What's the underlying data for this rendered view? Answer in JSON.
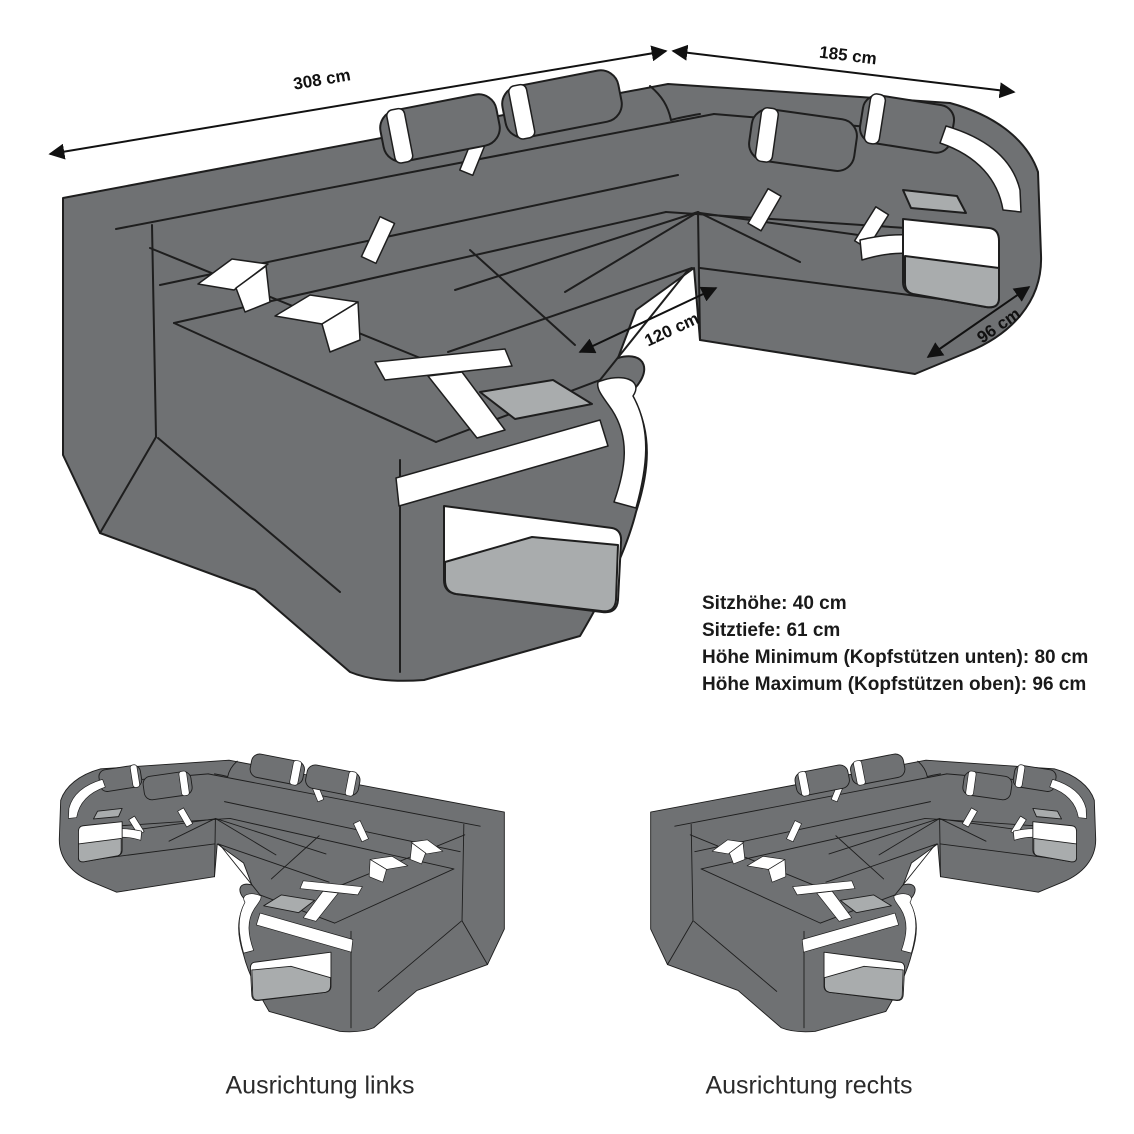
{
  "diagram": {
    "dimensions": {
      "back_width": "308 cm",
      "side_depth": "185 cm",
      "inner_width": "120 cm",
      "corner_depth": "96 cm"
    },
    "specs": {
      "line1": "Sitzhöhe: 40 cm",
      "line2": "Sitztiefe: 61 cm",
      "line3": "Höhe Minimum (Kopfstützen unten): 80 cm",
      "line4": "Höhe Maximum (Kopfstützen oben): 96 cm"
    },
    "variants": {
      "left_label": "Ausrichtung links",
      "right_label": "Ausrichtung rechts"
    },
    "colors": {
      "sofa_body": "#6f7173",
      "panel_light": "#a9acad",
      "accent_stripe": "#ffffff",
      "outline": "#1e1e1e",
      "text": "#1a1a1a"
    }
  }
}
